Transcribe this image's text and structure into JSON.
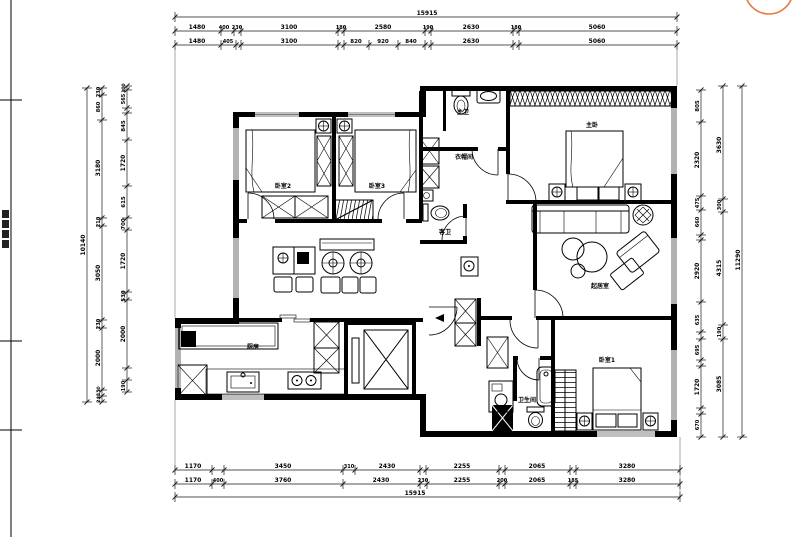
{
  "colors": {
    "line": "#000000",
    "accent": "#e8793f",
    "background": "#ffffff"
  },
  "marker": {
    "name": "orange-circle-marker",
    "color": "#e8793f"
  },
  "frame": {
    "border_x": 11,
    "tick_ys": [
      100,
      341,
      430
    ]
  },
  "rooms": [
    {
      "id": "bedroom-2",
      "label": "卧室2",
      "x": 283,
      "y": 188
    },
    {
      "id": "bedroom-3",
      "label": "卧室3",
      "x": 377,
      "y": 188
    },
    {
      "id": "master-bedroom",
      "label": "主卧",
      "x": 592,
      "y": 127
    },
    {
      "id": "master-bath",
      "label": "主卫",
      "x": 463,
      "y": 114
    },
    {
      "id": "cloakroom",
      "label": "衣帽间",
      "x": 464,
      "y": 159
    },
    {
      "id": "guest-bath",
      "label": "客卫",
      "x": 445,
      "y": 234
    },
    {
      "id": "living-room",
      "label": "起居室",
      "x": 600,
      "y": 288
    },
    {
      "id": "kitchen",
      "label": "厨房",
      "x": 253,
      "y": 349
    },
    {
      "id": "bedroom-1",
      "label": "卧室1",
      "x": 607,
      "y": 362
    },
    {
      "id": "bathroom",
      "label": "卫生间",
      "x": 527,
      "y": 402
    }
  ],
  "dims": {
    "h_rows": [
      {
        "y": 17,
        "x1": 175,
        "x2": 677,
        "ticks": [
          175,
          677
        ],
        "labels": [
          {
            "t": "15915",
            "x": 427
          }
        ]
      },
      {
        "y": 31,
        "x1": 175,
        "x2": 677,
        "ticks": [
          175,
          221,
          234,
          241,
          338,
          344,
          425,
          431,
          513,
          519,
          677
        ],
        "labels": [
          {
            "t": "1480",
            "x": 197
          },
          {
            "t": "400",
            "x": 224,
            "s": 5
          },
          {
            "t": "230",
            "x": 237,
            "s": 5
          },
          {
            "t": "3100",
            "x": 289
          },
          {
            "t": "180",
            "x": 341,
            "s": 5
          },
          {
            "t": "2580",
            "x": 383
          },
          {
            "t": "190",
            "x": 428,
            "s": 5
          },
          {
            "t": "2630",
            "x": 471
          },
          {
            "t": "180",
            "x": 516,
            "s": 5
          },
          {
            "t": "5060",
            "x": 597
          }
        ]
      },
      {
        "y": 45,
        "x1": 175,
        "x2": 677,
        "ticks": [
          175,
          221,
          236,
          241,
          338,
          344,
          369,
          398,
          425,
          431,
          513,
          519,
          677
        ],
        "labels": [
          {
            "t": "1480",
            "x": 197
          },
          {
            "t": "405",
            "x": 228,
            "s": 5
          },
          {
            "t": "3100",
            "x": 289
          },
          {
            "t": "820",
            "x": 356,
            "s": 5.5
          },
          {
            "t": "920",
            "x": 383,
            "s": 5.5
          },
          {
            "t": "840",
            "x": 411,
            "s": 5.5
          },
          {
            "t": "2630",
            "x": 471
          },
          {
            "t": "5060",
            "x": 597
          }
        ]
      },
      {
        "y": 470,
        "x1": 175,
        "x2": 680,
        "ticks": [
          175,
          212,
          224,
          343,
          355,
          420,
          426,
          499,
          505,
          570,
          576,
          680
        ],
        "labels": [
          {
            "t": "1170",
            "x": 193
          },
          {
            "t": "3450",
            "x": 283
          },
          {
            "t": "310",
            "x": 349,
            "s": 5
          },
          {
            "t": "2430",
            "x": 387
          },
          {
            "t": "2255",
            "x": 462
          },
          {
            "t": "2065",
            "x": 537
          },
          {
            "t": "3280",
            "x": 627
          }
        ]
      },
      {
        "y": 484,
        "x1": 175,
        "x2": 680,
        "ticks": [
          175,
          212,
          224,
          343,
          420,
          427,
          499,
          505,
          570,
          576,
          680
        ],
        "labels": [
          {
            "t": "1170",
            "x": 193
          },
          {
            "t": "400",
            "x": 218,
            "s": 5
          },
          {
            "t": "3760",
            "x": 283
          },
          {
            "t": "2430",
            "x": 381
          },
          {
            "t": "230",
            "x": 423,
            "s": 5
          },
          {
            "t": "2255",
            "x": 462
          },
          {
            "t": "200",
            "x": 502,
            "s": 5
          },
          {
            "t": "2065",
            "x": 537
          },
          {
            "t": "185",
            "x": 573,
            "s": 5
          },
          {
            "t": "3280",
            "x": 627
          }
        ]
      },
      {
        "y": 497,
        "x1": 175,
        "x2": 680,
        "ticks": [
          175,
          680
        ],
        "labels": [
          {
            "t": "15915",
            "x": 415
          }
        ]
      }
    ],
    "v_cols": [
      {
        "x": 87,
        "y1": 88,
        "y2": 402,
        "ticks": [
          88,
          402
        ],
        "labels": [
          {
            "t": "10140",
            "y": 245
          }
        ]
      },
      {
        "x": 102,
        "y1": 88,
        "y2": 402,
        "ticks": [
          88,
          95,
          120,
          218,
          226,
          320,
          328,
          390,
          396,
          402
        ],
        "labels": [
          {
            "t": "230",
            "y": 92,
            "s": 5
          },
          {
            "t": "860",
            "y": 107,
            "s": 5
          },
          {
            "t": "3180",
            "y": 168
          },
          {
            "t": "210",
            "y": 222,
            "s": 5
          },
          {
            "t": "3050",
            "y": 273
          },
          {
            "t": "230",
            "y": 324,
            "s": 5
          },
          {
            "t": "2000",
            "y": 358
          },
          {
            "t": "150",
            "y": 391,
            "s": 4.5
          },
          {
            "t": "240",
            "y": 398,
            "s": 4.5
          }
        ]
      },
      {
        "x": 127,
        "y1": 86,
        "y2": 392,
        "ticks": [
          86,
          90,
          108,
          113,
          140,
          186,
          218,
          230,
          292,
          300,
          368,
          380,
          392
        ],
        "labels": [
          {
            "t": "100",
            "y": 88,
            "s": 4.5
          },
          {
            "t": "565",
            "y": 99,
            "s": 5
          },
          {
            "t": "845",
            "y": 126,
            "s": 5.5
          },
          {
            "t": "1720",
            "y": 163
          },
          {
            "t": "615",
            "y": 202,
            "s": 5.5
          },
          {
            "t": "700",
            "y": 224,
            "s": 5.5
          },
          {
            "t": "1720",
            "y": 261
          },
          {
            "t": "530",
            "y": 296,
            "s": 5.5
          },
          {
            "t": "2000",
            "y": 334
          },
          {
            "t": "190",
            "y": 386,
            "s": 5
          }
        ]
      },
      {
        "x": 701,
        "y1": 90,
        "y2": 437,
        "ticks": [
          90,
          122,
          196,
          210,
          235,
          240,
          302,
          332,
          339,
          360,
          366,
          408,
          414,
          437
        ],
        "labels": [
          {
            "t": "805",
            "y": 106,
            "s": 5.5
          },
          {
            "t": "2320",
            "y": 160
          },
          {
            "t": "475",
            "y": 203,
            "s": 5
          },
          {
            "t": "660",
            "y": 222,
            "s": 5
          },
          {
            "t": "2920",
            "y": 271
          },
          {
            "t": "635",
            "y": 320,
            "s": 5
          },
          {
            "t": "695",
            "y": 350,
            "s": 5
          },
          {
            "t": "1720",
            "y": 387
          },
          {
            "t": "670",
            "y": 425,
            "s": 5
          }
        ]
      },
      {
        "x": 723,
        "y1": 86,
        "y2": 437,
        "ticks": [
          86,
          199,
          212,
          325,
          339,
          437
        ],
        "labels": [
          {
            "t": "3630",
            "y": 145
          },
          {
            "t": "300",
            "y": 205,
            "s": 5
          },
          {
            "t": "4315",
            "y": 268
          },
          {
            "t": "190",
            "y": 332,
            "s": 5
          },
          {
            "t": "3085",
            "y": 384
          }
        ]
      },
      {
        "x": 742,
        "y1": 86,
        "y2": 437,
        "ticks": [
          86,
          437
        ],
        "labels": [
          {
            "t": "11290",
            "y": 260
          }
        ]
      }
    ]
  }
}
